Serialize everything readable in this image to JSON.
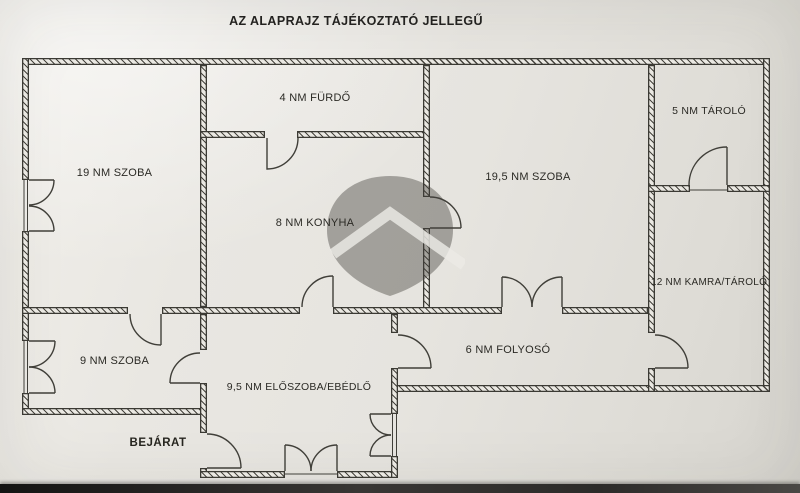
{
  "title": "AZ ALAPRAJZ TÁJÉKOZTATÓ JELLEGŰ",
  "entrance": {
    "label": "BEJÁRAT"
  },
  "rooms": {
    "furdo": {
      "label": "4 NM FÜRDŐ"
    },
    "tarolo": {
      "label": "5 NM TÁROLÓ"
    },
    "szoba19": {
      "label": "19 NM SZOBA"
    },
    "szoba195": {
      "label": "19,5 NM SZOBA"
    },
    "konyha": {
      "label": "8 NM KONYHA"
    },
    "kamra": {
      "label": "12 NM KAMRA/TÁROLÓ"
    },
    "szoba9": {
      "label": "9 NM SZOBA"
    },
    "eloszoba": {
      "label": "9,5 NM ELŐSZOBA/EBÉDLŐ"
    },
    "folyoso": {
      "label": "6 NM FOLYOSÓ"
    }
  },
  "colors": {
    "paper": "#e8e6e1",
    "wall_line": "#3b3a34",
    "text": "#2b2a25",
    "watermark": "rgba(66,64,60,0.42)",
    "photo_edge": "#141413"
  }
}
